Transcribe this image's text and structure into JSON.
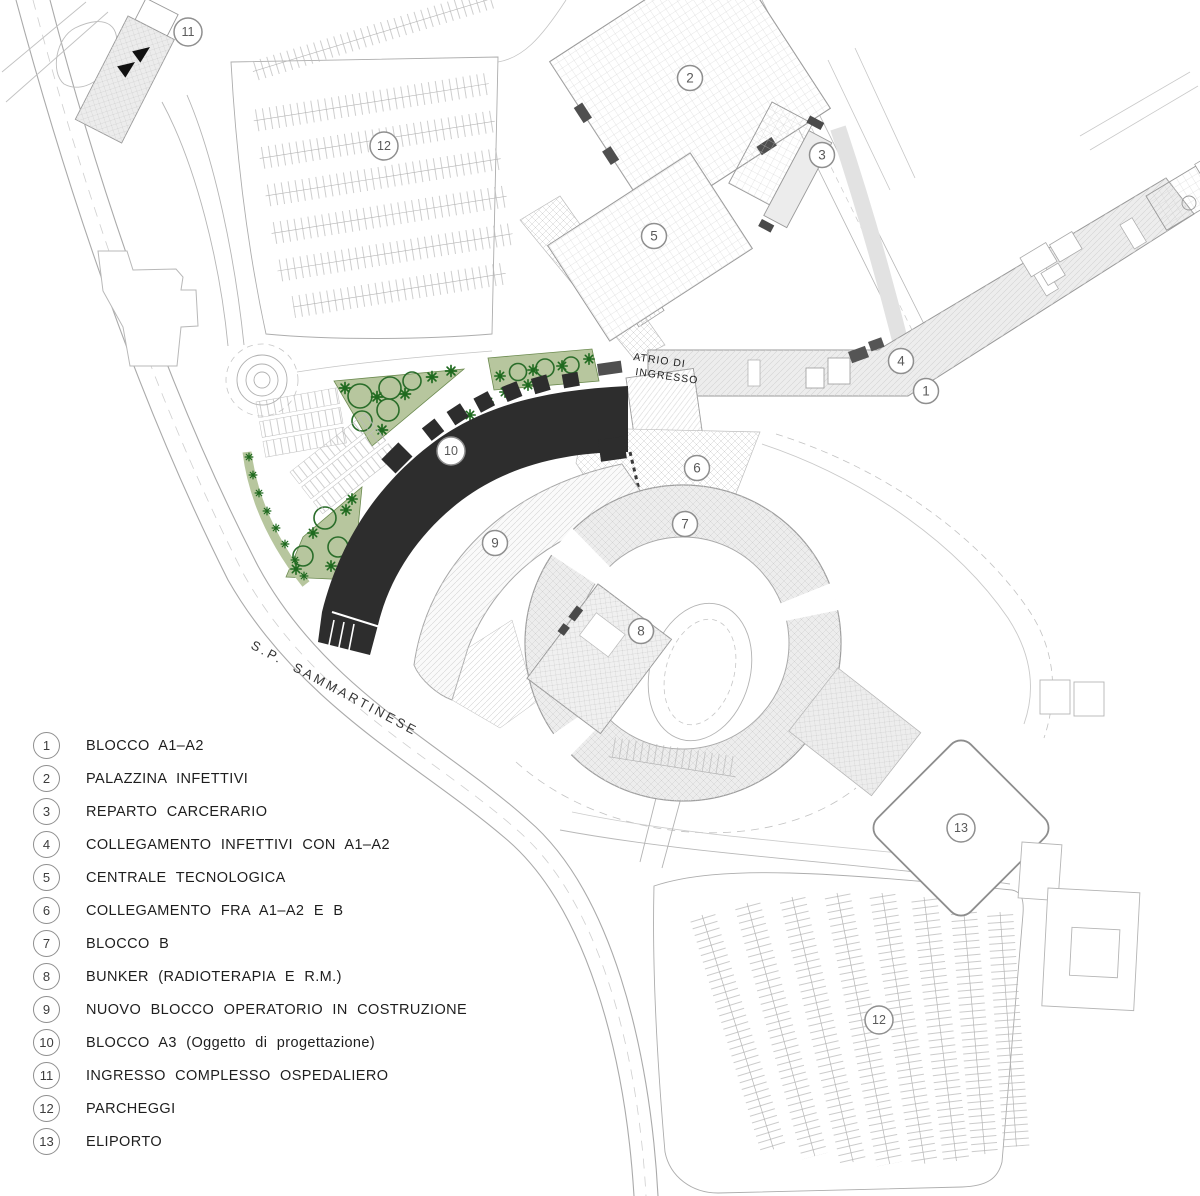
{
  "map": {
    "labels": {
      "atrio_line1": "ATRIO DI",
      "atrio_line2": "INGRESSO",
      "road": "S.P. SAMMARTINESE"
    },
    "markers": [
      {
        "n": "1",
        "x": 926,
        "y": 391
      },
      {
        "n": "2",
        "x": 690,
        "y": 78
      },
      {
        "n": "3",
        "x": 822,
        "y": 155
      },
      {
        "n": "4",
        "x": 901,
        "y": 361
      },
      {
        "n": "5",
        "x": 654,
        "y": 236
      },
      {
        "n": "6",
        "x": 697,
        "y": 468
      },
      {
        "n": "7",
        "x": 685,
        "y": 524
      },
      {
        "n": "8",
        "x": 641,
        "y": 631
      },
      {
        "n": "9",
        "x": 495,
        "y": 543
      },
      {
        "n": "10",
        "x": 451,
        "y": 451
      },
      {
        "n": "11",
        "x": 188,
        "y": 32
      },
      {
        "n": "12",
        "x": 384,
        "y": 146
      },
      {
        "n": "12",
        "x": 879,
        "y": 1020
      },
      {
        "n": "13",
        "x": 961,
        "y": 828
      }
    ]
  },
  "legend": {
    "items": [
      {
        "n": "1",
        "label": "BLOCCO A1–A2"
      },
      {
        "n": "2",
        "label": "PALAZZINA INFETTIVI"
      },
      {
        "n": "3",
        "label": "REPARTO CARCERARIO"
      },
      {
        "n": "4",
        "label": "COLLEGAMENTO INFETTIVI CON A1–A2"
      },
      {
        "n": "5",
        "label": "CENTRALE TECNOLOGICA"
      },
      {
        "n": "6",
        "label": "COLLEGAMENTO FRA A1–A2 E B"
      },
      {
        "n": "7",
        "label": "BLOCCO B"
      },
      {
        "n": "8",
        "label": "BUNKER (RADIOTERAPIA E R.M.)"
      },
      {
        "n": "9",
        "label": "NUOVO BLOCCO OPERATORIO IN COSTRUZIONE"
      },
      {
        "n": "10",
        "label": "BLOCCO A3 (Oggetto di progettazione)"
      },
      {
        "n": "11",
        "label": "INGRESSO COMPLESSO OSPEDALIERO"
      },
      {
        "n": "12",
        "label": "PARCHEGGI"
      },
      {
        "n": "13",
        "label": "ELIPORTO"
      }
    ]
  },
  "colors": {
    "building_dark": "#2d2d2d",
    "building_light": "#ededed",
    "green_fill": "#b7c69e",
    "green_dark": "#1f6a1f",
    "line_gray": "#9a9a9a",
    "marker_stroke": "#8f8f8f",
    "text_dark": "#1e1e1e"
  }
}
